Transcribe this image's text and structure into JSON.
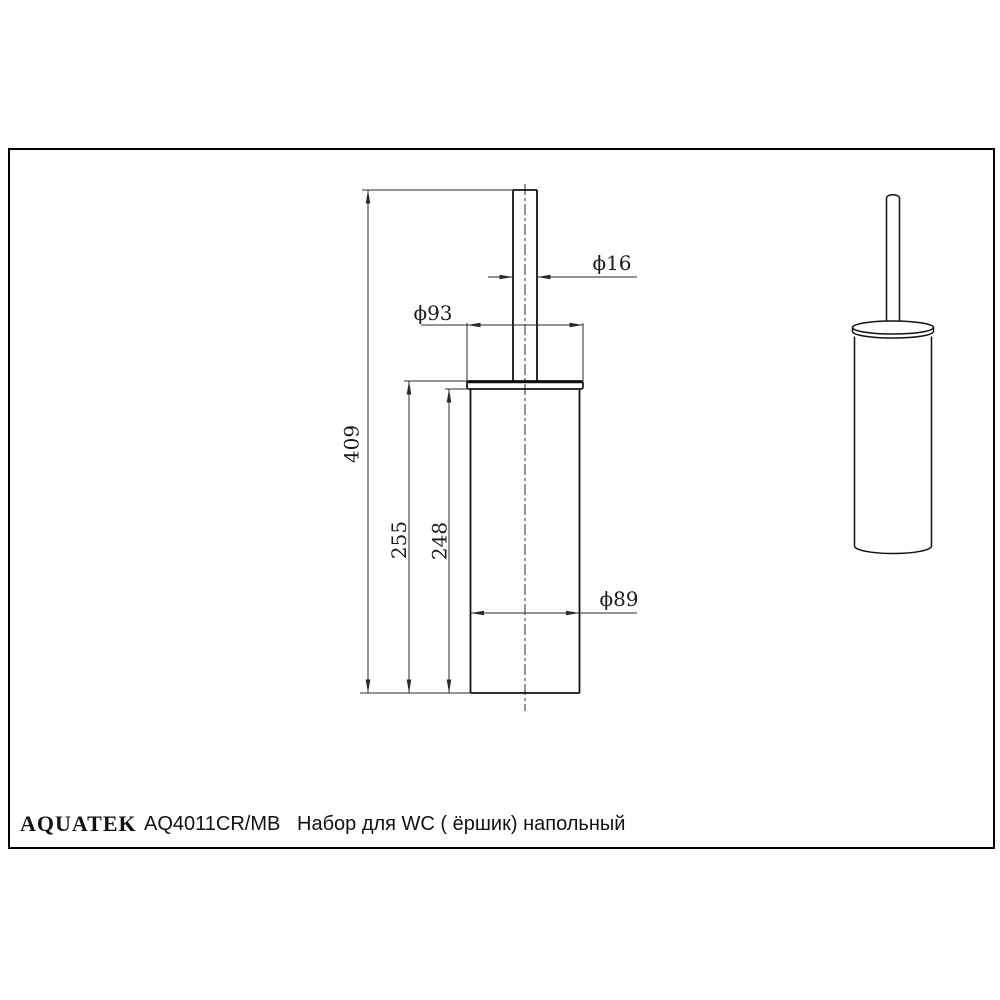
{
  "colors": {
    "ink": "#111111",
    "dim_ink": "#2a2a2a",
    "background": "#ffffff"
  },
  "footer": {
    "brand": "AQUATEK",
    "model": "AQ4011CR/MB",
    "description": "Набор для WC (  ёршик) напольный"
  },
  "dimensions": {
    "rod_diameter": "ϕ16",
    "lid_diameter": "ϕ93",
    "total_height": "409",
    "container_height": "255",
    "body_height": "248",
    "body_diameter": "ϕ89"
  }
}
